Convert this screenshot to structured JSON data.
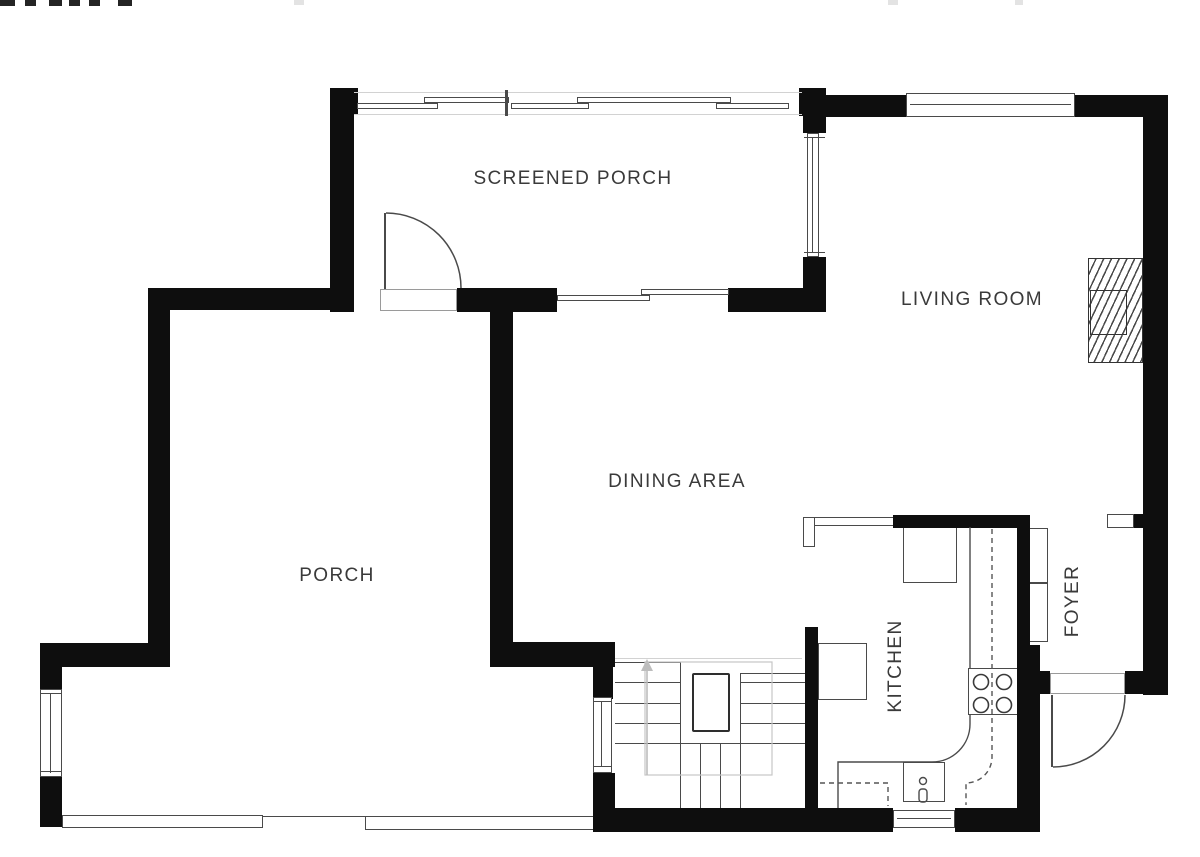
{
  "plan": {
    "colors": {
      "wall": "#0e0e0e",
      "line": "#4a4a4a",
      "line_light": "#d2d2d2",
      "text": "#3a3a3a",
      "bg": "#ffffff",
      "guide": "#bdbdbd"
    },
    "rooms": [
      {
        "id": "screened-porch",
        "label": "SCREENED PORCH"
      },
      {
        "id": "living-room",
        "label": "LIVING ROOM"
      },
      {
        "id": "dining-area",
        "label": "DINING AREA"
      },
      {
        "id": "porch",
        "label": "PORCH"
      },
      {
        "id": "kitchen",
        "label": "KITCHEN"
      },
      {
        "id": "foyer",
        "label": "FOYER"
      }
    ]
  }
}
